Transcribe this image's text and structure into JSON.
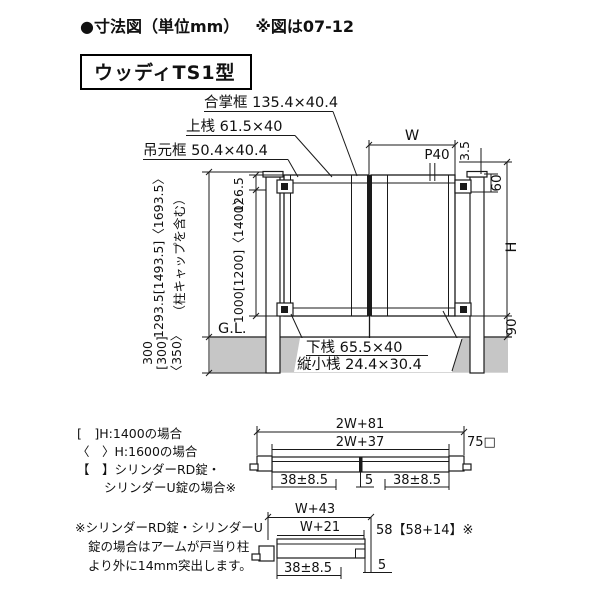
{
  "title": {
    "main": "●寸法図（単位mm）",
    "ref": "※図は07-12"
  },
  "model": "ウッディTS1型",
  "colors": {
    "ground": "#c6c6c6",
    "line": "#1a1a1a"
  },
  "gate": {
    "labels": {
      "meeting_stile": "合掌框 135.4×40.4",
      "top_rail": "上桟 61.5×40",
      "hinge_stile": "吊元框 50.4×40.4",
      "bottom_rail": "下桟 65.5×40",
      "vertical_slat": "縦小桟 24.4×30.4",
      "ground_line": "G.L."
    },
    "dims": {
      "width": "W",
      "pitch": "P40",
      "top_gap": "3.5",
      "hinge_offset": "60",
      "height": "H",
      "bottom_clearance": "90",
      "total_height": "1293.5[1493.5]〈1693.5〉",
      "total_height_note": "（柱キャップを含む）",
      "upper": "126.5",
      "panel_height": "1000[1200]〈1400〉",
      "embed_a": "300",
      "embed_b": "[300]",
      "embed_c": "〈350〉"
    }
  },
  "plan_double": {
    "outer": "2W+81",
    "inner": "2W+37",
    "post": "75□",
    "left_gap": "38±8.5",
    "center_gap": "5",
    "right_gap": "38±8.5"
  },
  "plan_single": {
    "outer": "W+43",
    "inner": "W+21",
    "arm": "58【58+14】※",
    "left_gap": "38±8.5",
    "gap": "5"
  },
  "legend": {
    "lines": [
      "[　]H:1400の場合",
      "〈　〉H:1600の場合",
      "【　】シリンダーRD錠・",
      "シリンダーU錠の場合※"
    ]
  },
  "note": {
    "lines": [
      "※シリンダーRD錠・シリンダーU",
      "錠の場合はアームが戸当り柱",
      "より外に14mm突出します。"
    ]
  }
}
